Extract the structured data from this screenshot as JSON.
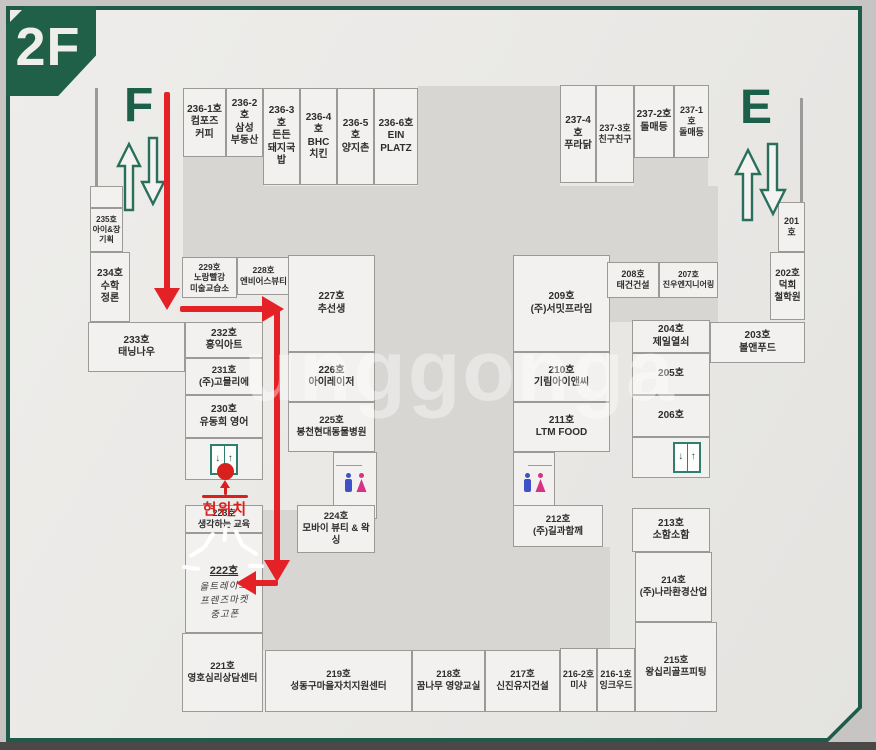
{
  "floor_badge": "2F",
  "watermark": "unggonga",
  "markers": {
    "f_label": "F",
    "e_label": "E",
    "current_location_label": "현위치"
  },
  "colors": {
    "frame_green": "#1e5b49",
    "badge_green": "#206049",
    "marker_green": "#1d6049",
    "path_red": "#e42127",
    "location_red": "#d8201e",
    "courtyard_gray": "#d7d6d3",
    "cell_fill": "#f2f1ef",
    "restroom_man_blue": "#3f51c9",
    "restroom_woman_pink": "#d63384"
  },
  "room222": {
    "no": "222호",
    "l1": "올트레이드",
    "l2": "프렌즈마켓",
    "l3": "중고폰"
  },
  "rooms": [
    {
      "no": "236-1호",
      "name": "컴포즈 커피",
      "x": 183,
      "y": 88,
      "w": 43,
      "h": 69
    },
    {
      "no": "236-2호",
      "name": "삼성\n부동산",
      "x": 226,
      "y": 88,
      "w": 37,
      "h": 69
    },
    {
      "no": "236-3호",
      "name": "든든\n돼지국밥",
      "x": 263,
      "y": 88,
      "w": 37,
      "h": 97
    },
    {
      "no": "236-4호",
      "name": "BHC\n치킨",
      "x": 300,
      "y": 88,
      "w": 37,
      "h": 97
    },
    {
      "no": "236-5호",
      "name": "양지촌",
      "x": 337,
      "y": 88,
      "w": 37,
      "h": 97
    },
    {
      "no": "236-6호",
      "name": "EIN\nPLATZ",
      "x": 374,
      "y": 88,
      "w": 44,
      "h": 97
    },
    {
      "no": "237-4호",
      "name": "푸라닭",
      "x": 560,
      "y": 85,
      "w": 36,
      "h": 98
    },
    {
      "no": "237-3호",
      "name": "친구친구",
      "x": 596,
      "y": 85,
      "w": 38,
      "h": 98,
      "fs": 9
    },
    {
      "no": "237-2호",
      "name": "돌매등",
      "x": 634,
      "y": 85,
      "w": 40,
      "h": 73
    },
    {
      "no": "237-1호",
      "name": "돌매등",
      "x": 674,
      "y": 85,
      "w": 35,
      "h": 73,
      "fs": 9
    },
    {
      "no": "",
      "name": "",
      "x": 90,
      "y": 186,
      "w": 33,
      "h": 22
    },
    {
      "no": "235호",
      "name": "아이&장\n기획",
      "x": 90,
      "y": 208,
      "w": 33,
      "h": 44,
      "fs": 8
    },
    {
      "no": "234호",
      "name": "수학\n정론",
      "x": 90,
      "y": 252,
      "w": 40,
      "h": 70
    },
    {
      "no": "233호",
      "name": "태닝나우",
      "x": 88,
      "y": 322,
      "w": 97,
      "h": 50
    },
    {
      "no": "232호",
      "name": "홍익아트",
      "x": 185,
      "y": 322,
      "w": 78,
      "h": 36
    },
    {
      "no": "231호",
      "name": "(주)고믈리에",
      "x": 185,
      "y": 358,
      "w": 78,
      "h": 37,
      "fs": 9.5
    },
    {
      "no": "230호",
      "name": "유동희 영어",
      "x": 185,
      "y": 395,
      "w": 78,
      "h": 43
    },
    {
      "no": "229호",
      "name": "노랑빨강\n미술교습소",
      "x": 182,
      "y": 257,
      "w": 55,
      "h": 41,
      "fs": 8.5
    },
    {
      "no": "228호",
      "name": "엔비어스뷰티",
      "x": 237,
      "y": 257,
      "w": 53,
      "h": 38,
      "fs": 8.5
    },
    {
      "no": "227호",
      "name": "추선생",
      "x": 288,
      "y": 255,
      "w": 87,
      "h": 97
    },
    {
      "no": "226호",
      "name": "아이레이저",
      "x": 288,
      "y": 352,
      "w": 87,
      "h": 50
    },
    {
      "no": "225호",
      "name": "봉천현대동물병원",
      "x": 288,
      "y": 402,
      "w": 87,
      "h": 50,
      "fs": 9.5
    },
    {
      "no": "224호",
      "name": "모바이 뷰티 & 왁싱",
      "x": 297,
      "y": 505,
      "w": 78,
      "h": 48,
      "fs": 9.5
    },
    {
      "no": "209호",
      "name": "(주)서밋프라임",
      "x": 513,
      "y": 255,
      "w": 97,
      "h": 97
    },
    {
      "no": "210호",
      "name": "기림아이앤씨",
      "x": 513,
      "y": 352,
      "w": 97,
      "h": 50
    },
    {
      "no": "211호",
      "name": "LTM FOOD",
      "x": 513,
      "y": 402,
      "w": 97,
      "h": 50
    },
    {
      "no": "212호",
      "name": "(주)길과함께",
      "x": 513,
      "y": 505,
      "w": 90,
      "h": 42,
      "fs": 9.5
    },
    {
      "no": "208호",
      "name": "태건건설",
      "x": 607,
      "y": 262,
      "w": 52,
      "h": 36,
      "fs": 9
    },
    {
      "no": "207호",
      "name": "진우엔지니어링",
      "x": 659,
      "y": 262,
      "w": 59,
      "h": 36,
      "fs": 8
    },
    {
      "no": "204호",
      "name": "제일열쇠",
      "x": 632,
      "y": 320,
      "w": 78,
      "h": 33
    },
    {
      "no": "205호",
      "name": "",
      "x": 632,
      "y": 353,
      "w": 78,
      "h": 42
    },
    {
      "no": "206호",
      "name": "",
      "x": 632,
      "y": 395,
      "w": 78,
      "h": 42
    },
    {
      "no": "213호",
      "name": "소함소함",
      "x": 632,
      "y": 508,
      "w": 78,
      "h": 44
    },
    {
      "no": "214호",
      "name": "(주)나라환경산업",
      "x": 635,
      "y": 552,
      "w": 77,
      "h": 70,
      "fs": 9.5
    },
    {
      "no": "215호",
      "name": "왕십리골프피팅",
      "x": 635,
      "y": 622,
      "w": 82,
      "h": 90,
      "fs": 9.5
    },
    {
      "no": "201호",
      "name": "",
      "x": 778,
      "y": 202,
      "w": 27,
      "h": 50,
      "fs": 9
    },
    {
      "no": "202호",
      "name": "덕희\n철학원",
      "x": 770,
      "y": 252,
      "w": 35,
      "h": 68,
      "fs": 9.5
    },
    {
      "no": "203호",
      "name": "볼앤푸드",
      "x": 710,
      "y": 322,
      "w": 95,
      "h": 41
    },
    {
      "no": "223호",
      "name": "생각하는 교육",
      "x": 185,
      "y": 505,
      "w": 78,
      "h": 28,
      "fs": 9
    },
    {
      "no": "221호",
      "name": "영호심리상담센터",
      "x": 182,
      "y": 633,
      "w": 81,
      "h": 79,
      "fs": 9.5
    },
    {
      "no": "219호",
      "name": "성동구마을자치지원센터",
      "x": 265,
      "y": 650,
      "w": 147,
      "h": 62,
      "fs": 9.5
    },
    {
      "no": "218호",
      "name": "꿈나무 영양교실",
      "x": 412,
      "y": 650,
      "w": 73,
      "h": 62,
      "fs": 9.5
    },
    {
      "no": "217호",
      "name": "신진유지건설",
      "x": 485,
      "y": 650,
      "w": 75,
      "h": 62,
      "fs": 9.5
    },
    {
      "no": "216-2호",
      "name": "미샤",
      "x": 560,
      "y": 648,
      "w": 37,
      "h": 64,
      "fs": 9
    },
    {
      "no": "216-1호",
      "name": "잉크우드",
      "x": 597,
      "y": 648,
      "w": 38,
      "h": 64,
      "fs": 9
    }
  ]
}
